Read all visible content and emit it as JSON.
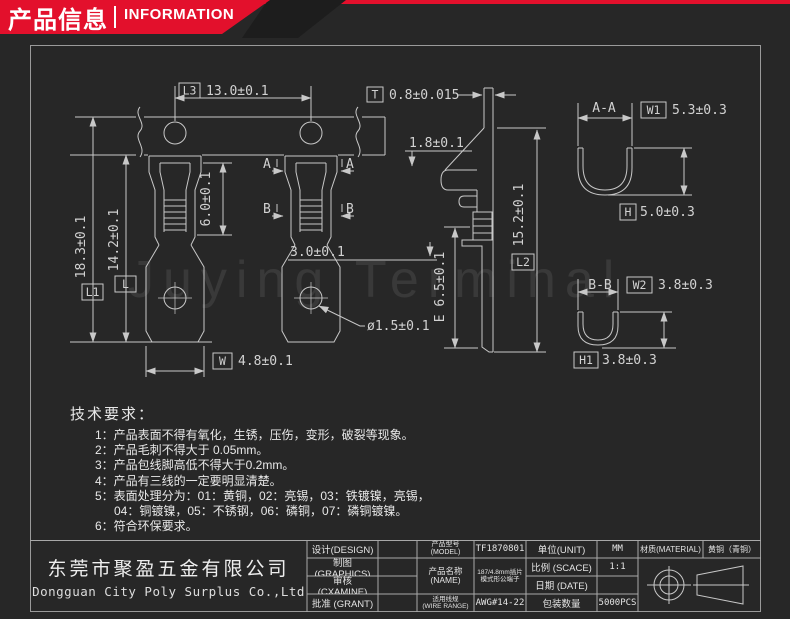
{
  "banner": {
    "title_cn": "产品信息",
    "title_en": "INFORMATION"
  },
  "watermark": "Juying Terminal",
  "drawing": {
    "front": {
      "l3_tag": "L3",
      "l3": "13.0±0.1",
      "h60": "6.0±0.1",
      "l1_tag": "L1",
      "l1": "18.3±0.1",
      "l_tag": "L",
      "l": "14.2±0.1",
      "w_tag": "W",
      "w": "4.8±0.1",
      "hole": "ø1.5±0.1",
      "a": "A",
      "b": "B"
    },
    "side": {
      "t_tag": "T",
      "t": "0.8±0.015",
      "d18": "1.8±0.1",
      "d30": "3.0±0.1",
      "e": "E 6.5±0.1",
      "l2_tag": "L2",
      "l2": "15.2±0.1"
    },
    "aa": {
      "title": "A-A",
      "w1_tag": "W1",
      "w1": "5.3±0.3",
      "h_tag": "H",
      "h": "5.0±0.3"
    },
    "bb": {
      "title": "B-B",
      "w2_tag": "W2",
      "w2": "3.8±0.3",
      "h1_tag": "H1",
      "h1": "3.8±0.3"
    }
  },
  "tech_requirements": {
    "title": "技术要求：",
    "items": [
      "1：产品表面不得有氧化，生锈，压伤，变形，破裂等现象。",
      "2：产品毛刺不得大于 0.05mm。",
      "3：产品包线脚高低不得大于0.2mm。",
      "4：产品有三线的一定要明显清楚。",
      "5：表面处理分为：01：黄铜，02：亮锡，03：铁镀镍，亮锡，",
      "04：铜镀镍，05：不锈钢，06：磷铜，07：磷铜镀镍。",
      "6：符合环保要求。"
    ]
  },
  "title_block": {
    "company_cn": "东莞市聚盈五金有限公司",
    "company_en": "Dongguan City Poly Surplus Co.,Ltd",
    "design_label": "设计(DESIGN)",
    "graphics_label": "制图(GRAPHICS)",
    "examine_label": "审核 (CXAMINE)",
    "grant_label": "批准 (GRANT)",
    "model_label_cn": "产品型号",
    "model_label_en": "(MODEL)",
    "model_value": "TF1870801",
    "name_label_cn": "产品名称",
    "name_label_en": "(NAME)",
    "name_value_line1": "187/4.8mm插片",
    "name_value_line2": "模式形公端子",
    "wire_label_cn": "适用线规",
    "wire_label_en": "(WIRE RANGE)",
    "wire_value": "AWG#14-22",
    "unit_label": "单位(UNIT)",
    "unit_value": "MM",
    "scale_label": "比例 (SCACE)",
    "scale_value": "1:1",
    "date_label": "日期 (DATE)",
    "date_value": "",
    "qty_label": "包装数量",
    "qty_value": "5000PCS",
    "material_label": "材质(MATERIAL)",
    "material_value": "黄铜（青铜）"
  },
  "colors": {
    "accent": "#e3102c",
    "background": "#272727",
    "line": "#c8c8c8"
  }
}
